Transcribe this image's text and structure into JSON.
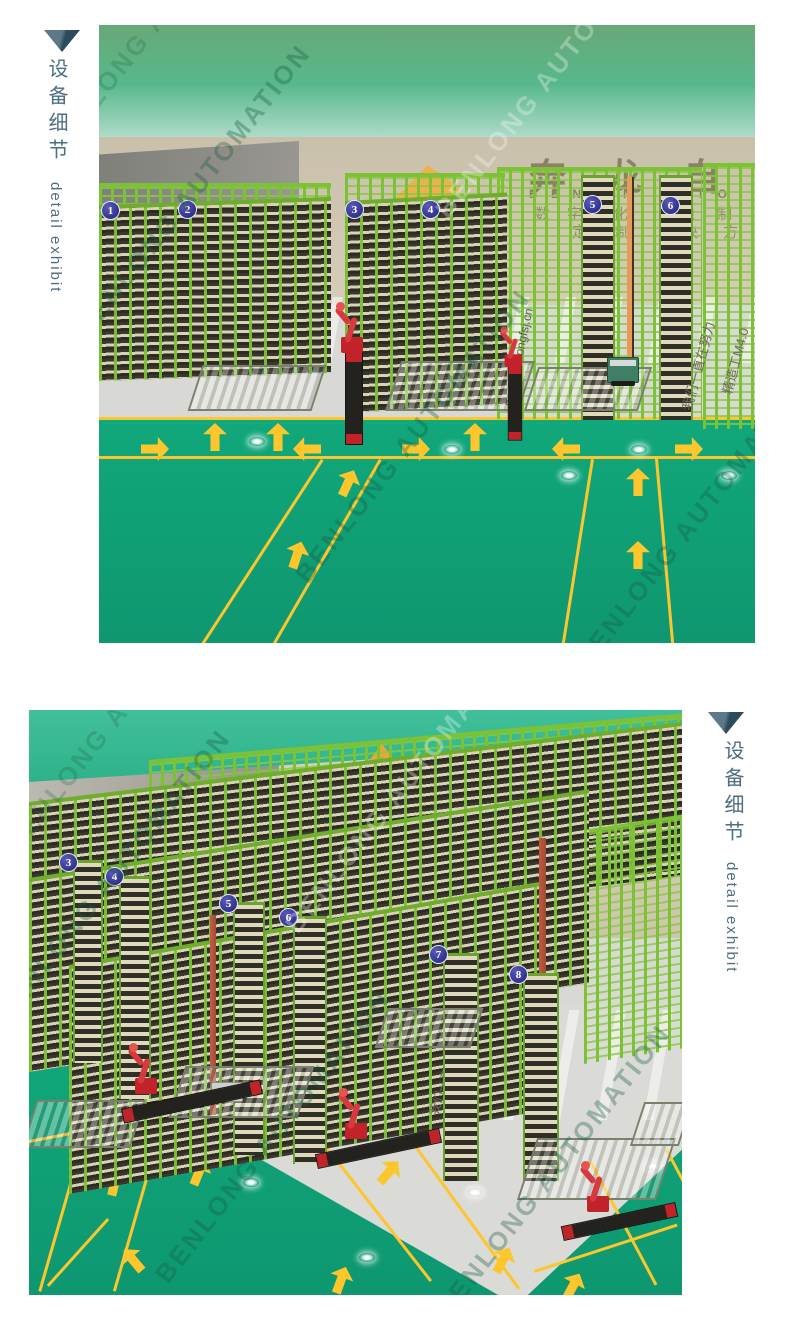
{
  "header": {
    "title_zh": "设备细节",
    "title_en": "detail exhibit",
    "text_color": "#4d6f82",
    "triangle_color": "#3c5a6c"
  },
  "watermark": {
    "text": "BENLONG AUTOMATION"
  },
  "scene1": {
    "wall_chars": [
      "奔",
      "龙",
      "自"
    ],
    "wall_latin": [
      "B E N",
      "N",
      "U T O"
    ],
    "wall_sub_row1": [
      "数",
      "字",
      "化",
      "能",
      "制"
    ],
    "wall_sub_row2": [
      "定",
      "制",
      "决",
      "方"
    ],
    "rack_labels": [
      "1",
      "2",
      "3",
      "4",
      "5",
      "6"
    ],
    "floor_url": "www.benlongfsj.cn",
    "floor_slogan_1": "精造工M4.0",
    "floor_slogan_2": "我们一直在努力"
  },
  "scene2": {
    "wall_chars": [
      "奔",
      "龙",
      "自"
    ],
    "wall_latin": [
      "A"
    ],
    "rack_labels": [
      "3",
      "4",
      "5",
      "6",
      "7",
      "8"
    ],
    "floor_slogan": "我们一直在努力"
  },
  "colors": {
    "ceiling_green": "#4fb98d",
    "floor_green": "#13a077",
    "lane_yellow": "#fdc62d",
    "rack_green": "#7cc135",
    "badge_blue": "#34349b",
    "robot_red": "#d3262b",
    "wall_beige": "#cfc6af",
    "wall_gray": "#90908b",
    "wall_text_brown": "#8d8266"
  }
}
